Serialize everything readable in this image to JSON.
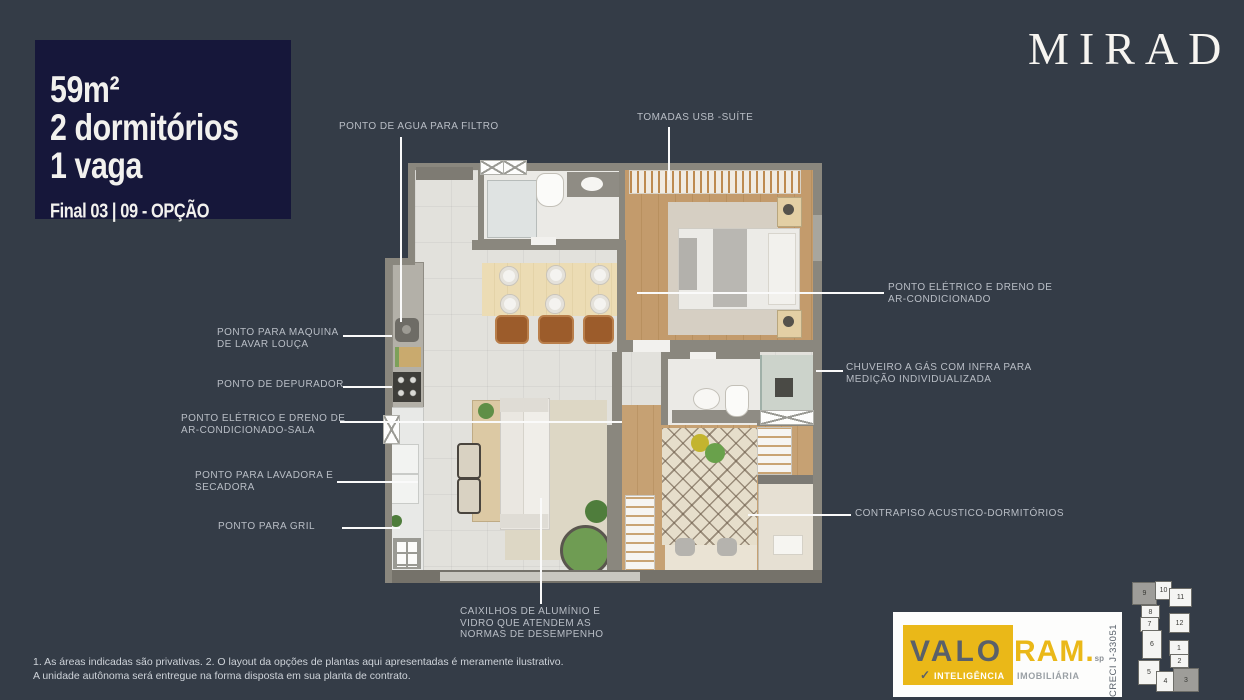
{
  "brand": {
    "logo_text": "MIRAD"
  },
  "badge": {
    "area": "59m²",
    "bedrooms": "2 dormitórios",
    "parking": "1 vaga",
    "unit": "Final 03 | 09 - OPÇÃO"
  },
  "callouts": {
    "agua_filtro": {
      "lines": [
        "PONTO DE AGUA PARA FILTRO"
      ]
    },
    "tomadas_usb": {
      "lines": [
        "TOMADAS USB -SUÍTE"
      ]
    },
    "ac_suite": {
      "lines": [
        "PONTO ELÉTRICO E DRENO DE",
        "AR-CONDICIONADO"
      ]
    },
    "chuveiro": {
      "lines": [
        "CHUVEIRO A GÁS COM INFRA PARA",
        "MEDIÇÃO INDIVIDUALIZADA"
      ]
    },
    "lava_louca": {
      "lines": [
        "PONTO PARA MAQUINA",
        "DE LAVAR LOUÇA"
      ]
    },
    "depurador": {
      "lines": [
        "PONTO DE DEPURADOR"
      ]
    },
    "ac_sala": {
      "lines": [
        "PONTO ELÉTRICO E DRENO DE",
        "AR-CONDICIONADO-SALA"
      ]
    },
    "lavadora": {
      "lines": [
        "PONTO PARA LAVADORA E",
        "SECADORA"
      ]
    },
    "gril": {
      "lines": [
        "PONTO PARA GRIL"
      ]
    },
    "contrapiso": {
      "lines": [
        "CONTRAPISO ACUSTICO-DORMITÓRIOS"
      ]
    },
    "caixilhos": {
      "lines": [
        "CAIXILHOS DE ALUMÍNIO E",
        "VIDRO QUE ATENDEM AS",
        "NORMAS DE DESEMPENHO"
      ]
    }
  },
  "footnote": {
    "line1": "1. As áreas indicadas são privativas. 2. O layout da opções de plantas aqui apresentadas é meramente ilustrativo.",
    "line2": "A unidade autônoma será entregue na forma disposta em sua planta de contrato."
  },
  "valoram": {
    "valo": "VALO",
    "ram": "RAM.",
    "sp": "sp",
    "tagline_left": "INTELIGÊNCIA",
    "tagline_right": "IMOBILIÁRIA",
    "creci": "CRECI J-33051",
    "accent_color": "#eab818"
  },
  "keyplan": {
    "highlighted_units": [
      "9",
      "3"
    ],
    "units": {
      "u1": "1",
      "u2": "2",
      "u3": "3",
      "u4": "4",
      "u5": "5",
      "u6": "6",
      "u7": "7",
      "u8": "8",
      "u9": "9",
      "u10": "10",
      "u11": "11",
      "u12": "12"
    }
  },
  "colors": {
    "background": "#343c47",
    "badge_bg": "#16173a",
    "wall": "#8a877e",
    "accent_yellow": "#eab818"
  }
}
